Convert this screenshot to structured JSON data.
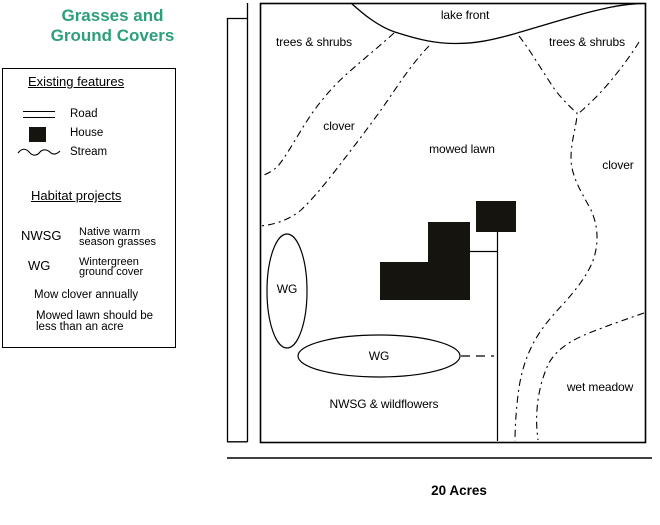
{
  "title": {
    "line1": "Grasses and",
    "line2": "Ground Covers",
    "color": "#2E9E7C"
  },
  "legend": {
    "existing_heading": "Existing features",
    "items": [
      {
        "symbol": "road-symbol",
        "label": "Road"
      },
      {
        "symbol": "house-symbol",
        "label": "House"
      },
      {
        "symbol": "stream-symbol",
        "label": "Stream"
      }
    ],
    "habitat_heading": "Habitat projects",
    "habitat_items": [
      {
        "abbr": "NWSG",
        "desc_line1": "Native warm",
        "desc_line2": "season grasses"
      },
      {
        "abbr": "WG",
        "desc_line1": "Wintergreen",
        "desc_line2": "ground cover"
      }
    ],
    "note1": "Mow clover annually",
    "note2_line1": "Mowed lawn should be",
    "note2_line2": "less than an acre"
  },
  "map": {
    "labels": {
      "lake_front": "lake front",
      "trees_shrubs_left": "trees & shrubs",
      "trees_shrubs_right": "trees & shrubs",
      "clover_left": "clover",
      "mowed_lawn": "mowed lawn",
      "clover_right": "clover",
      "wg_vertical": "WG",
      "wg_horizontal": "WG",
      "nwsg_wildflowers": "NWSG & wildflowers",
      "wet_meadow": "wet meadow"
    },
    "acreage": "20 Acres",
    "line_color": "#000000",
    "house_color": "#15140f"
  }
}
